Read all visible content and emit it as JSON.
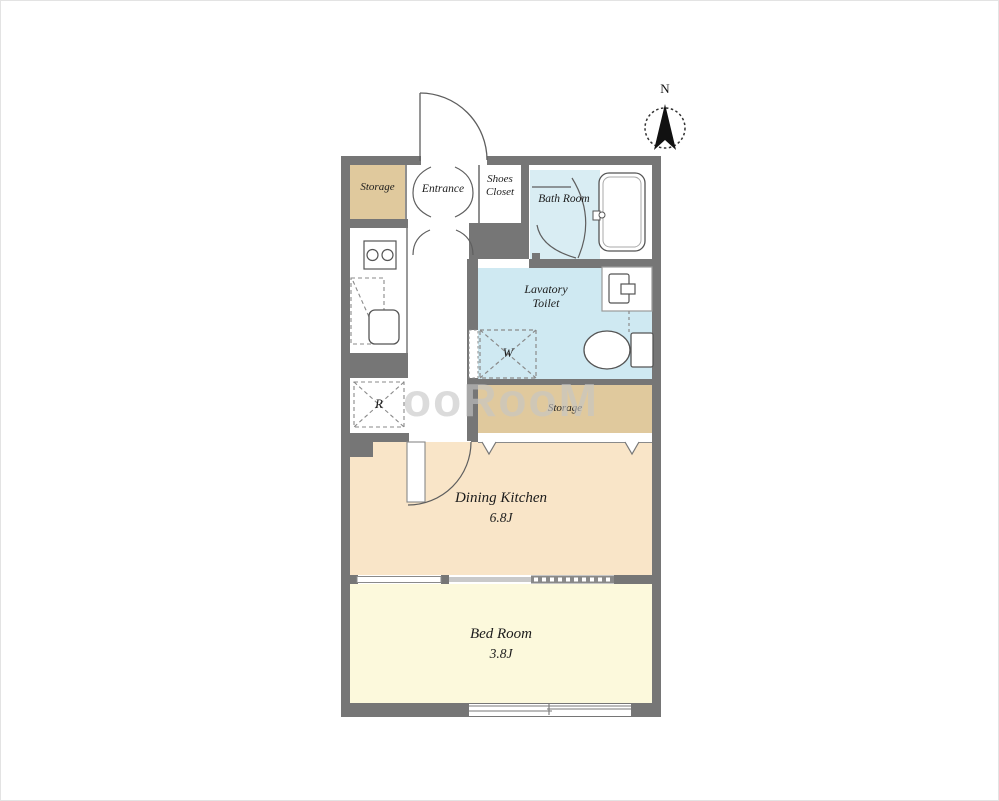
{
  "compass": {
    "north": "N"
  },
  "watermark": {
    "text": "ooRooM"
  },
  "rooms": {
    "storage_entry": {
      "label": "Storage"
    },
    "entrance": {
      "label": "Entrance"
    },
    "shoes_closet": {
      "line1": "Shoes",
      "line2": "Closet"
    },
    "bath_room": {
      "label": "Bath Room"
    },
    "lavatory_toilet": {
      "line1": "Lavatory",
      "line2": "Toilet"
    },
    "storage_hall": {
      "label": "Storage"
    },
    "dining_kitchen": {
      "label": "Dining Kitchen",
      "area": "6.8J"
    },
    "bed_room": {
      "label": "Bed Room",
      "area": "3.8J"
    }
  },
  "fixtures": {
    "washing_machine_label": "W",
    "refrigerator_label": "R"
  },
  "colors": {
    "wall": "#767676",
    "storage": "#e0c99d",
    "bathroom": "#d9edf3",
    "lavatory": "#cfe9f2",
    "dining_kitchen": "#f9e5c8",
    "bed_room": "#fcf9dc",
    "watermark": "#c6c6c6"
  }
}
